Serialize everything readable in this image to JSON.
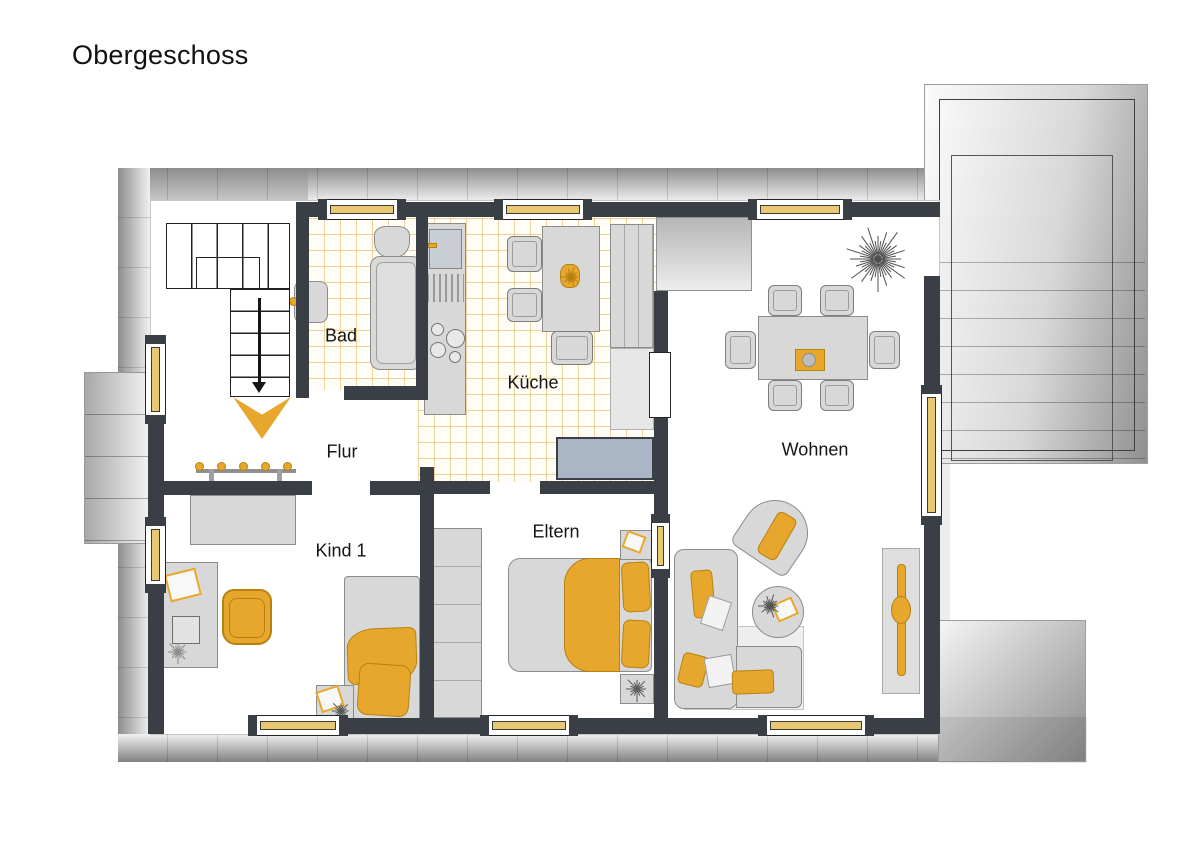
{
  "title": "Obergeschoss",
  "rooms": {
    "bad": {
      "label": "Bad"
    },
    "kueche": {
      "label": "Küche"
    },
    "flur": {
      "label": "Flur"
    },
    "wohnen": {
      "label": "Wohnen"
    },
    "kind1": {
      "label": "Kind 1"
    },
    "eltern": {
      "label": "Eltern"
    }
  },
  "colors": {
    "wall": "#3a3f46",
    "accent": "#e6a72c",
    "accent_dark": "#b8820f",
    "window_glass": "#e9c873",
    "furniture_fill": "#d8d8d8",
    "furniture_border": "#8c8c8c",
    "tile_line": "rgba(223,170,60,0.5)",
    "sideboard_blue": "#aab6c5",
    "text": "#141414"
  }
}
